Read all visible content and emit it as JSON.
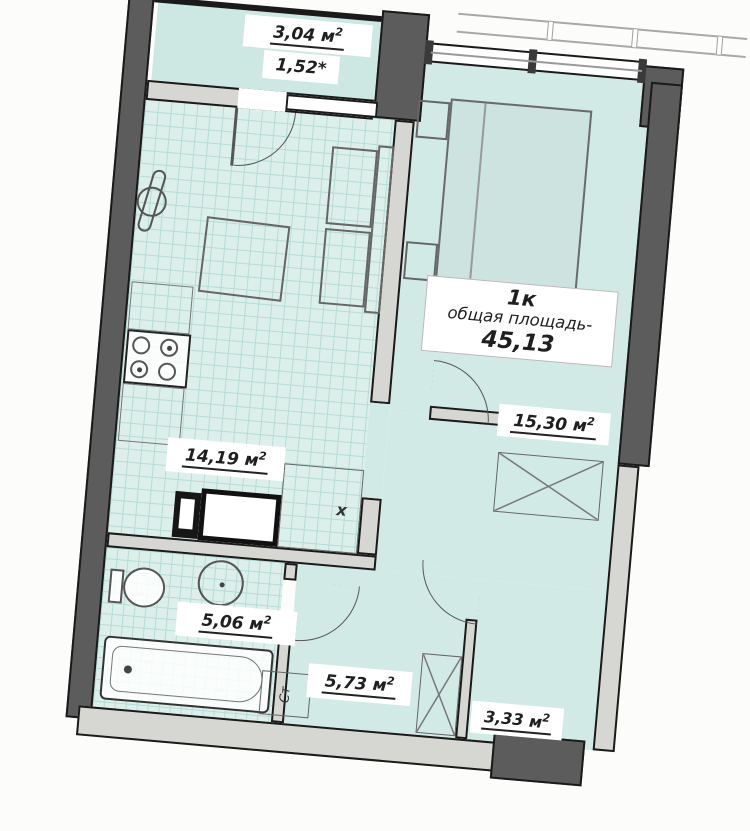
{
  "colors": {
    "wall-dark": "#5c5c5c",
    "wall-light": "#d6d6d3",
    "outline": "#1a1a1a",
    "floor-plain": "#d2eae6",
    "floor-tile": "#dcefeb",
    "tile-line": "#b6dcd5",
    "balcony-floor": "#cde7e3",
    "fixture": "#555555",
    "label-bg": "#ffffff",
    "text": "#1f1f1f"
  },
  "plan": {
    "type_label": "1к",
    "total_area_label": "общая площадь-",
    "total_area_value": "45,13",
    "unit": "м",
    "unit_sup": "2",
    "rooms": {
      "balcony": {
        "area": "3,04",
        "coef": "1,52*"
      },
      "kitchen": {
        "area": "14,19"
      },
      "room": {
        "area": "15,30"
      },
      "bathroom": {
        "area": "5,06"
      },
      "hall": {
        "area": "5,73"
      },
      "entry": {
        "area": "3,33"
      }
    },
    "markers": {
      "fridge": "х",
      "riser": "Ст"
    }
  }
}
